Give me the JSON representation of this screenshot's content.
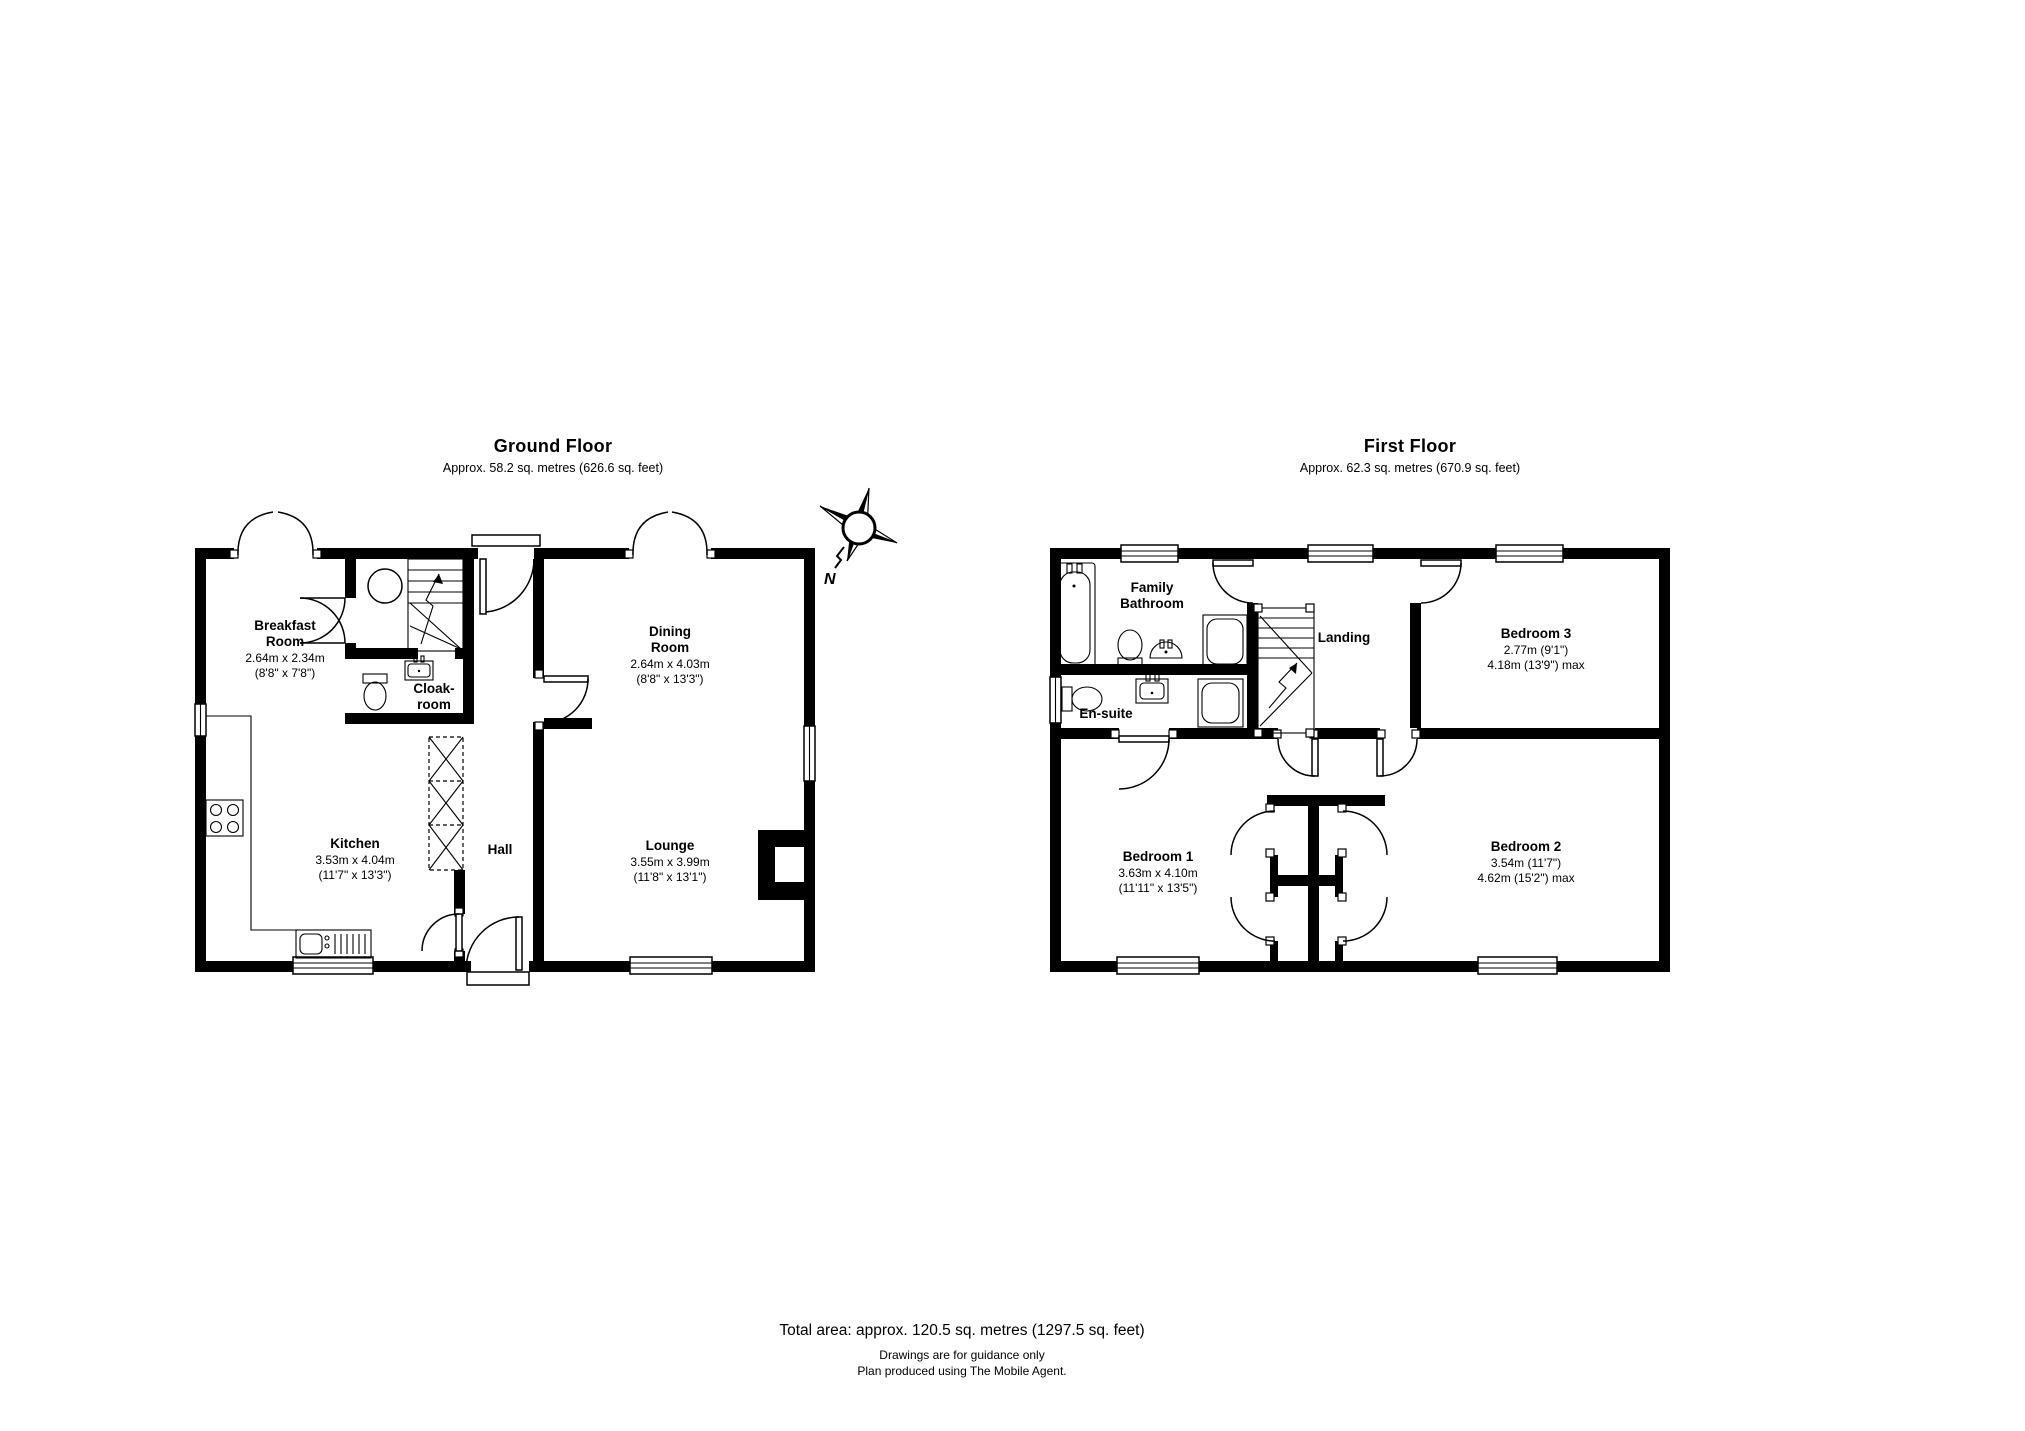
{
  "ground_floor": {
    "title": "Ground Floor",
    "subtitle": "Approx. 58.2 sq. metres (626.6 sq. feet)",
    "rooms": {
      "breakfast": {
        "name1": "Breakfast",
        "name2": "Room",
        "metric": "2.64m x 2.34m",
        "imperial": "(8'8\" x 7'8\")"
      },
      "cloakroom": {
        "name1": "Cloak-",
        "name2": "room"
      },
      "kitchen": {
        "name": "Kitchen",
        "metric": "3.53m x 4.04m",
        "imperial": "(11'7\" x 13'3\")"
      },
      "hall": {
        "name": "Hall"
      },
      "dining": {
        "name1": "Dining",
        "name2": "Room",
        "metric": "2.64m x 4.03m",
        "imperial": "(8'8\" x 13'3\")"
      },
      "lounge": {
        "name": "Lounge",
        "metric": "3.55m x 3.99m",
        "imperial": "(11'8\" x 13'1\")"
      }
    }
  },
  "first_floor": {
    "title": "First Floor",
    "subtitle": "Approx. 62.3 sq. metres (670.9 sq. feet)",
    "rooms": {
      "family_bathroom": {
        "name1": "Family",
        "name2": "Bathroom"
      },
      "ensuite": {
        "name": "En-suite"
      },
      "landing": {
        "name": "Landing"
      },
      "bedroom1": {
        "name": "Bedroom 1",
        "metric": "3.63m x 4.10m",
        "imperial": "(11'11\" x 13'5\")"
      },
      "bedroom2": {
        "name": "Bedroom 2",
        "metric": "3.54m (11'7\")",
        "imperial": "4.62m (15'2\") max"
      },
      "bedroom3": {
        "name": "Bedroom 3",
        "metric": "2.77m (9'1\")",
        "imperial": "4.18m (13'9\") max"
      }
    }
  },
  "compass": {
    "north_label": "N"
  },
  "footer": {
    "total_area": "Total area: approx. 120.5 sq. metres (1297.5 sq. feet)",
    "note1": "Drawings are for guidance only",
    "note2": "Plan produced using The Mobile Agent."
  }
}
